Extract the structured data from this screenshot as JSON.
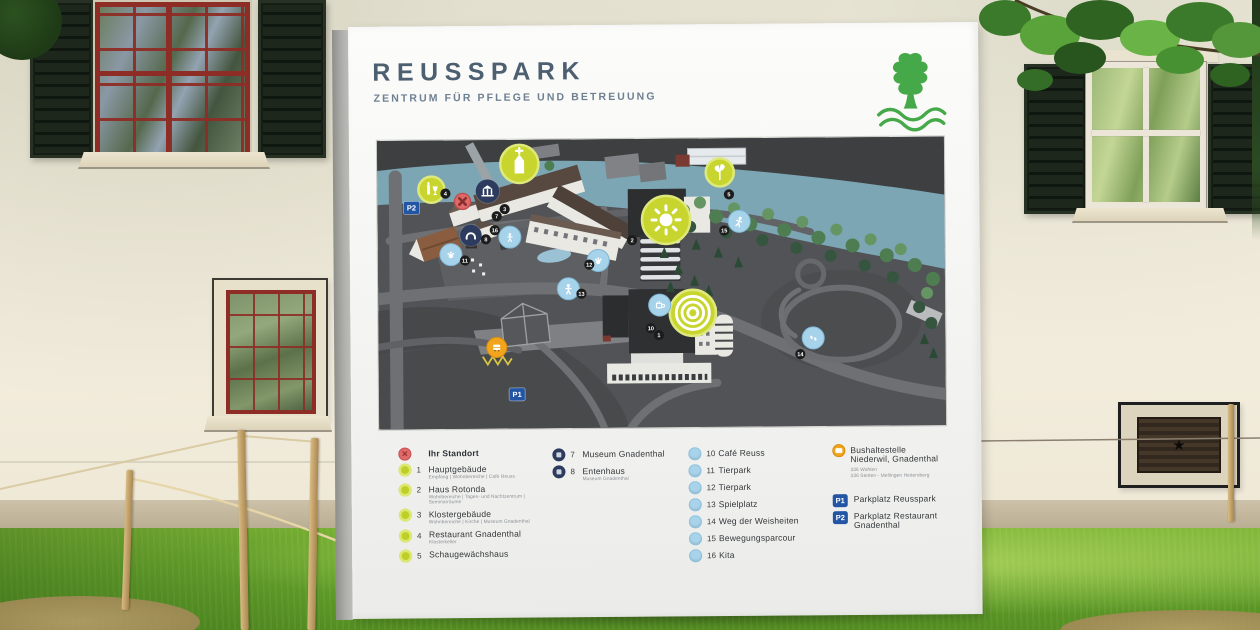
{
  "sign": {
    "title": "REUSSPARK",
    "subtitle": "ZENTRUM FÜR PFLEGE UND BETREUUNG",
    "title_color": "#4d6072",
    "logo_color": "#45a949"
  },
  "legend": {
    "col1": {
      "standort": {
        "label": "Ihr Standort"
      },
      "items": [
        {
          "num": "1",
          "label": "Hauptgebäude",
          "sub": "Empfang | Wohnbereiche | Café Reuss"
        },
        {
          "num": "2",
          "label": "Haus Rotonda",
          "sub": "Wohnbereiche | Tages- und Nachtzentrum | Seminarräume"
        },
        {
          "num": "3",
          "label": "Klostergebäude",
          "sub": "Wohnbereiche | Kirche | Museum Gnadenthal"
        },
        {
          "num": "4",
          "label": "Restaurant Gnadenthal",
          "sub": "Klosterkeller"
        },
        {
          "num": "5",
          "label": "Schaugewächshaus",
          "sub": ""
        }
      ]
    },
    "col2": {
      "items": [
        {
          "num": "7",
          "label": "Museum Gnadenthal",
          "sub": ""
        },
        {
          "num": "8",
          "label": "Entenhaus",
          "sub": "Museum Gnadenthal"
        }
      ]
    },
    "col3": {
      "items": [
        {
          "num": "10",
          "label": "Café Reuss"
        },
        {
          "num": "11",
          "label": "Tierpark"
        },
        {
          "num": "12",
          "label": "Tierpark"
        },
        {
          "num": "13",
          "label": "Spielplatz"
        },
        {
          "num": "14",
          "label": "Weg der Weisheiten"
        },
        {
          "num": "15",
          "label": "Bewegungsparcour"
        },
        {
          "num": "16",
          "label": "Kita"
        }
      ]
    },
    "col4": {
      "bus": {
        "label_line1": "Bushaltestelle",
        "label_line2": "Niederwil, Gnadenthal",
        "sub1": "336 Wohlen",
        "sub2": "336 Stetten - Mellingen Heitersberg"
      },
      "p1": {
        "code": "P1",
        "label": "Parkplatz  Reusspark"
      },
      "p2": {
        "code": "P2",
        "label": "Parkplatz Restaurant Gnadenthal"
      }
    }
  },
  "map": {
    "palette": {
      "highlight": "#c8d52f",
      "info": "#2d3c5e",
      "poi": "#a6d2ea",
      "bus": "#f2a41d",
      "parking": "#2256a5",
      "standort": "#dd6a6a"
    },
    "markers": [
      {
        "name": "klostergebaeude",
        "x": 142,
        "y": 24,
        "r": 19,
        "fill": "highlight",
        "icon": "church"
      },
      {
        "name": "restaurant-gnadenthal",
        "x": 54,
        "y": 49,
        "r": 13,
        "fill": "highlight",
        "icon": "wine"
      },
      {
        "name": "haus-rotonda",
        "x": 288,
        "y": 81,
        "r": 24,
        "fill": "highlight",
        "icon": "sun"
      },
      {
        "name": "schaugewaechshaus",
        "x": 342,
        "y": 34,
        "r": 14,
        "fill": "highlight",
        "icon": "plant"
      },
      {
        "name": "hauptgebaeude",
        "x": 314,
        "y": 174,
        "r": 23,
        "fill": "highlight",
        "icon": "rings"
      },
      {
        "name": "museum-gnadenthal",
        "x": 110,
        "y": 51,
        "r": 12,
        "fill": "info",
        "icon": "museum"
      },
      {
        "name": "entenhaus",
        "x": 93,
        "y": 95,
        "r": 11,
        "fill": "info",
        "icon": "duck"
      },
      {
        "name": "cafe-reuss",
        "x": 281,
        "y": 166,
        "r": 11,
        "fill": "poi",
        "icon": "cup"
      },
      {
        "name": "tierpark-west",
        "x": 73,
        "y": 114,
        "r": 11,
        "fill": "poi",
        "icon": "paw"
      },
      {
        "name": "tierpark-ost",
        "x": 220,
        "y": 121,
        "r": 11,
        "fill": "poi",
        "icon": "paw"
      },
      {
        "name": "spielplatz",
        "x": 190,
        "y": 149,
        "r": 11,
        "fill": "poi",
        "icon": "person"
      },
      {
        "name": "weg-der-weisheiten",
        "x": 434,
        "y": 200,
        "r": 11,
        "fill": "poi",
        "icon": "steps"
      },
      {
        "name": "bewegungsparcour",
        "x": 361,
        "y": 83,
        "r": 11,
        "fill": "poi",
        "icon": "runner"
      },
      {
        "name": "kita",
        "x": 132,
        "y": 97,
        "r": 11,
        "fill": "poi",
        "icon": "child"
      },
      {
        "name": "bushaltestelle",
        "x": 118,
        "y": 207,
        "r": 10,
        "fill": "bus",
        "icon": "bus"
      }
    ],
    "badges": [
      {
        "n": "1",
        "x": 280,
        "y": 196
      },
      {
        "n": "2",
        "x": 254,
        "y": 101
      },
      {
        "n": "3",
        "x": 127,
        "y": 69
      },
      {
        "n": "4",
        "x": 68,
        "y": 53
      },
      {
        "n": "5",
        "x": 351,
        "y": 56
      },
      {
        "n": "7",
        "x": 119,
        "y": 76
      },
      {
        "n": "8",
        "x": 108,
        "y": 99
      },
      {
        "n": "10",
        "x": 272,
        "y": 189
      },
      {
        "n": "11",
        "x": 87,
        "y": 120
      },
      {
        "n": "12",
        "x": 211,
        "y": 125
      },
      {
        "n": "13",
        "x": 203,
        "y": 154
      },
      {
        "n": "14",
        "x": 421,
        "y": 216
      },
      {
        "n": "15",
        "x": 346,
        "y": 92
      },
      {
        "n": "16",
        "x": 117,
        "y": 90
      }
    ],
    "plates": [
      {
        "code": "P1",
        "x": 138,
        "y": 254
      },
      {
        "code": "P2",
        "x": 34,
        "y": 67
      }
    ],
    "standort": {
      "x": 85,
      "y": 61
    }
  }
}
